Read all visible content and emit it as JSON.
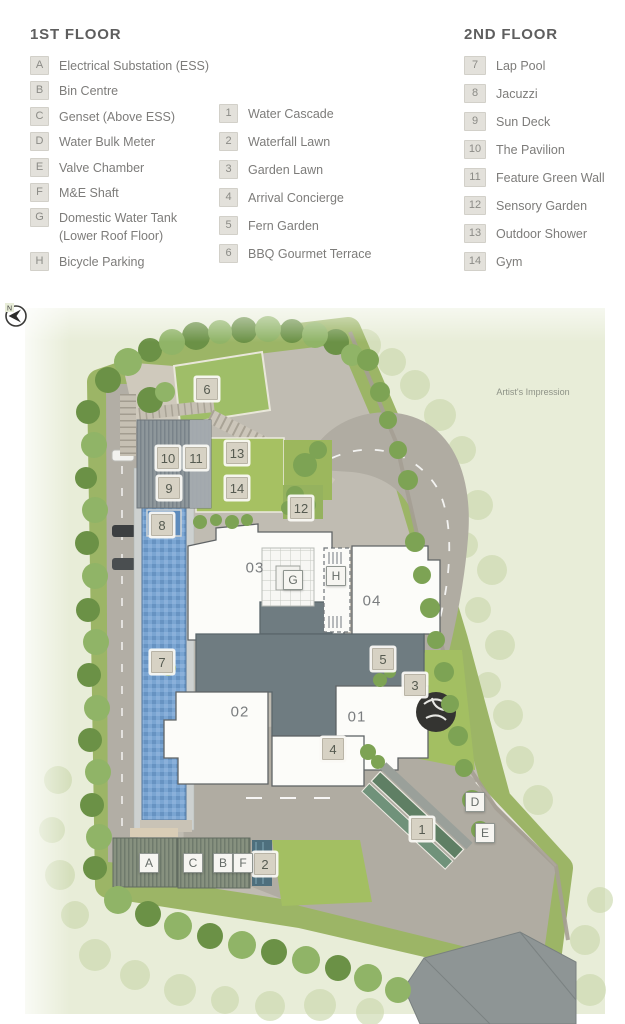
{
  "legend": {
    "first_floor": {
      "title": "1ST FLOOR",
      "items": [
        {
          "key": "A",
          "label": "Electrical Substation (ESS)"
        },
        {
          "key": "B",
          "label": "Bin Centre"
        },
        {
          "key": "C",
          "label": "Genset (Above ESS)"
        },
        {
          "key": "D",
          "label": "Water Bulk Meter"
        },
        {
          "key": "E",
          "label": "Valve Chamber"
        },
        {
          "key": "F",
          "label": "M&E Shaft"
        },
        {
          "key": "G",
          "label": "Domestic Water Tank",
          "label2": "(Lower Roof Floor)"
        },
        {
          "key": "H",
          "label": "Bicycle Parking"
        }
      ]
    },
    "amenities": {
      "items": [
        {
          "key": "1",
          "label": "Water Cascade"
        },
        {
          "key": "2",
          "label": "Waterfall Lawn"
        },
        {
          "key": "3",
          "label": "Garden Lawn"
        },
        {
          "key": "4",
          "label": "Arrival Concierge"
        },
        {
          "key": "5",
          "label": "Fern Garden"
        },
        {
          "key": "6",
          "label": "BBQ Gourmet Terrace"
        }
      ]
    },
    "second_floor": {
      "title": "2ND FLOOR",
      "items": [
        {
          "key": "7",
          "label": "Lap Pool"
        },
        {
          "key": "8",
          "label": "Jacuzzi"
        },
        {
          "key": "9",
          "label": "Sun Deck"
        },
        {
          "key": "10",
          "label": "The Pavilion"
        },
        {
          "key": "11",
          "label": "Feature Green Wall"
        },
        {
          "key": "12",
          "label": "Sensory Garden"
        },
        {
          "key": "13",
          "label": "Outdoor Shower"
        },
        {
          "key": "14",
          "label": "Gym"
        }
      ]
    }
  },
  "plan": {
    "note": "Artist's Impression",
    "compass": "N",
    "buildings": {
      "b01": "01",
      "b02": "02",
      "b03": "03",
      "b04": "04"
    },
    "markers": {
      "m1": "1",
      "m2": "2",
      "m3": "3",
      "m4": "4",
      "m5": "5",
      "m6": "6",
      "m7": "7",
      "m8": "8",
      "m9": "9",
      "m10": "10",
      "m11": "11",
      "m12": "12",
      "m13": "13",
      "m14": "14",
      "mA": "A",
      "mB": "B",
      "mC": "C",
      "mD": "D",
      "mE": "E",
      "mF": "F",
      "mG": "G",
      "mH": "H"
    }
  },
  "colors": {
    "pool": "#6f9cca",
    "lawn": "#a3bf62",
    "road": "#b0aca2",
    "building": "#fcfcf9",
    "connector": "#6f7c81",
    "chip_tan": "#d7d2c4"
  }
}
